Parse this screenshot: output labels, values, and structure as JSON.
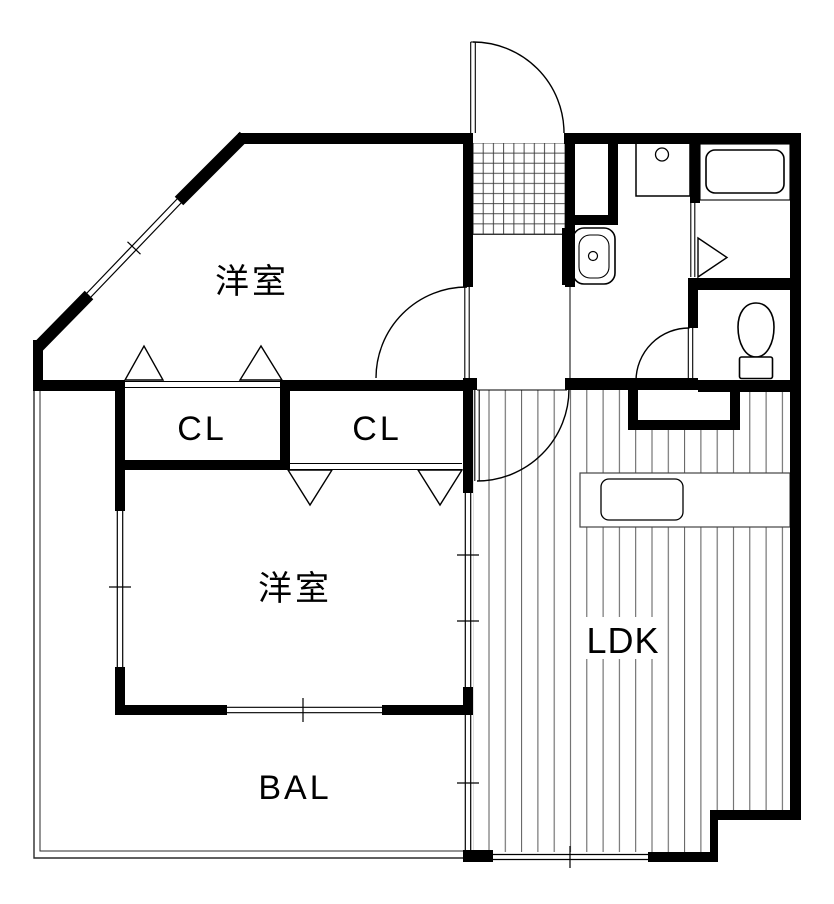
{
  "floorplan": {
    "rooms": {
      "bedroom_upper": {
        "label": "洋室"
      },
      "bedroom_lower": {
        "label": "洋室"
      },
      "closet_upper": {
        "label": "CL"
      },
      "closet_lower": {
        "label": "CL"
      },
      "ldk": {
        "label": "LDK"
      },
      "balcony": {
        "label": "BAL"
      }
    },
    "colors": {
      "wall": "#000000",
      "thin_line": "#1a1a1a",
      "floor_hatch": "#5a5a5a",
      "background": "#ffffff"
    }
  }
}
